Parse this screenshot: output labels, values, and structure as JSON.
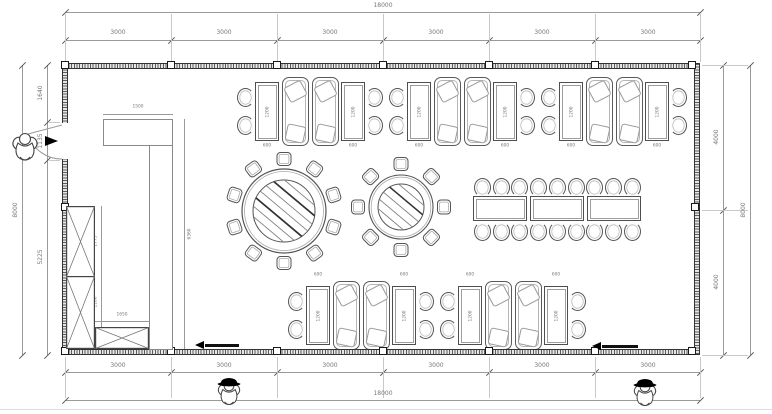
{
  "plan": {
    "dims": {
      "overall_width": "18000",
      "overall_height": "8000",
      "top_segments": [
        "3000",
        "3000",
        "3000",
        "3000",
        "3000",
        "3000"
      ],
      "bottom_segments": [
        "3000",
        "3000",
        "3000",
        "3000",
        "3000",
        "3000"
      ],
      "left_segments": [
        "1640",
        "1135",
        "5225"
      ],
      "right_segments": [
        "4000",
        "4000"
      ],
      "counter_width": "1500",
      "partition_length": "6360",
      "cabinet_upper": "2775",
      "cabinet_lower": "1100",
      "sideboard_width": "1650",
      "table_width": "600",
      "table_length": "1200"
    }
  }
}
